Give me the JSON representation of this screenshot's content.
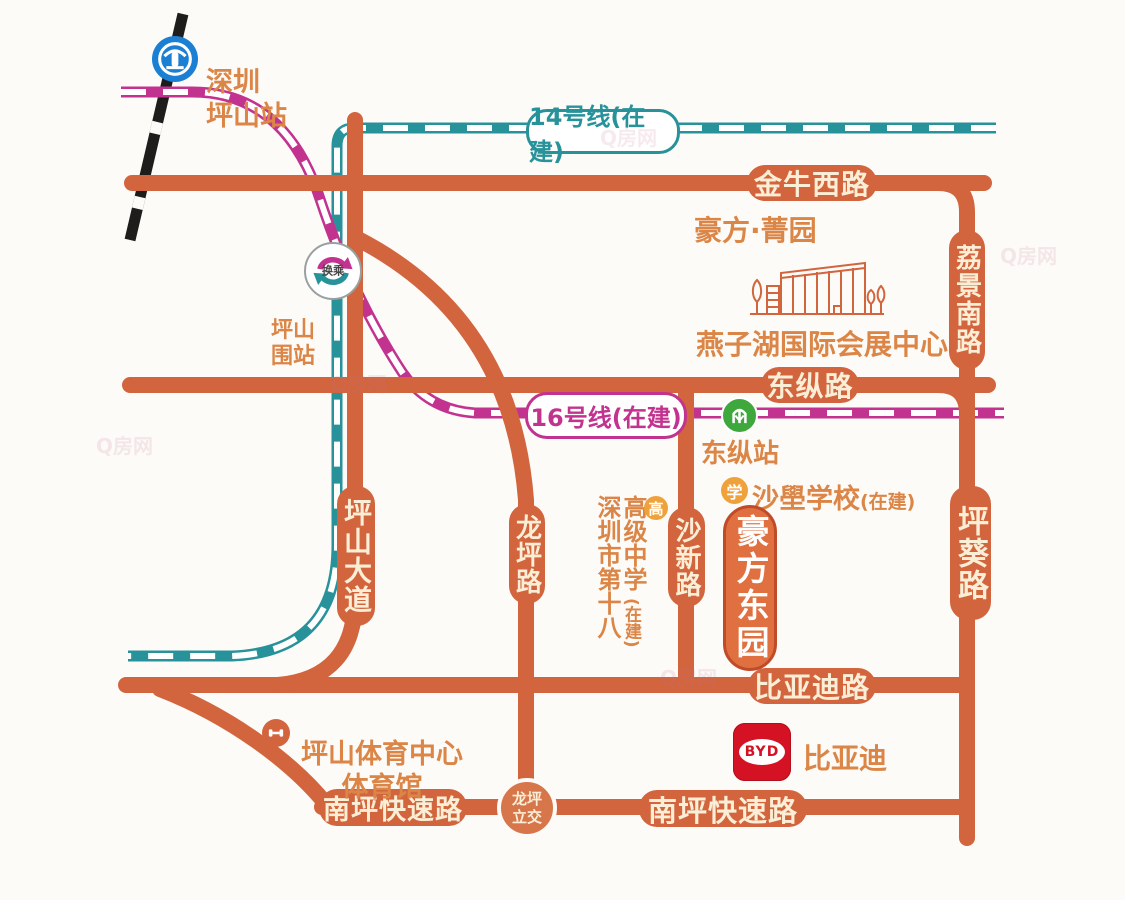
{
  "map_title": "豪方东园区位示意图",
  "colors": {
    "road": "#D2653E",
    "road_text": "#FAEFD6",
    "poi_text": "#DB8546",
    "line14_teal": "#28929A",
    "line16_magenta": "#C23390",
    "railway_black": "#1F1D1C",
    "station_blue": "#1B7FD4",
    "metro_green": "#3FA83C",
    "badge_orange": "#EFA23B",
    "byd_red": "#D41224",
    "project_fill": "#E0703F",
    "project_border": "#BF4B28"
  },
  "metro": {
    "line14_label": "14号线(在建)",
    "line16_label": "16号线(在建)",
    "transfer_badge": "换乘",
    "station_shenzhen_pingshan": "深圳\n坪山站",
    "station_pingshanwei": "坪山\n围站",
    "station_dongzong": "东纵站"
  },
  "roads": {
    "jinniu_west": "金牛西路",
    "dongzong": "东纵路",
    "lijing_south": "荔景南路",
    "pingshan_avenue": "坪山大道",
    "longping": "龙坪路",
    "shaxin": "沙新路",
    "pingkui": "坪葵路",
    "byd_road": "比亚迪路",
    "nanping_expressway_west": "南坪快速路",
    "nanping_expressway_east": "南坪快速路",
    "longping_interchange": "龙坪\n立交"
  },
  "pois": {
    "haofang_jingyuan": "豪方·菁园",
    "yanzihu_center": "燕子湖国际会展中心",
    "shabo_school": "沙壆学校",
    "shabo_school_status": "(在建)",
    "school_badge": "学",
    "highschool_badge": "高",
    "project_name": "豪方东园",
    "school18_col1": "深圳市第十八",
    "school18_col2": "高级中学",
    "school18_status": "(在建)",
    "sports_center": "坪山体育中心\n体育馆",
    "byd_company": "比亚迪",
    "byd_logo_text": "BYD"
  },
  "watermark": "Q房网"
}
